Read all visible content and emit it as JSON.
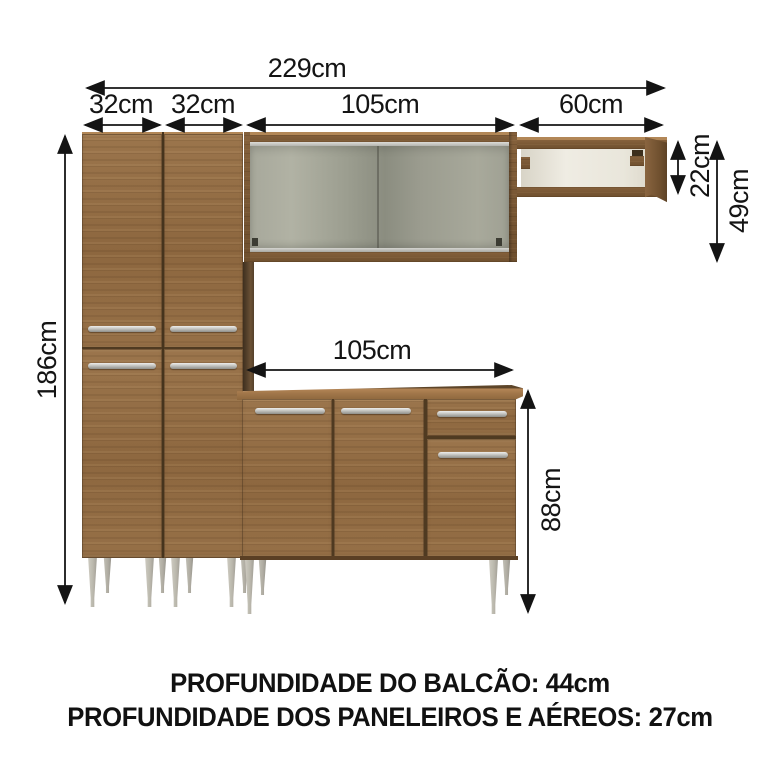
{
  "diagram": {
    "dims": {
      "total_width": "229cm",
      "paneleiro1_width": "32cm",
      "paneleiro2_width": "32cm",
      "aereo_width": "105cm",
      "prateleira_width": "60cm",
      "paneleiro_height": "186cm",
      "balcao_width": "105cm",
      "prateleira_height": "22cm",
      "aereo_height": "49cm",
      "balcao_height": "88cm"
    },
    "footer": {
      "balcao_depth": "PROFUNDIDADE DO BALCÃO: 44cm",
      "paneleiro_depth": "PROFUNDIDADE DOS PANELEIROS E AÉREOS: 27cm"
    },
    "colors": {
      "wood": "#96704a",
      "wood_dark": "#6e4f2e",
      "glass": "#a0a194",
      "shelf_interior": "#ece9e0",
      "legs": "#bab7ac",
      "dimension_lines": "#1a1a1a"
    }
  }
}
